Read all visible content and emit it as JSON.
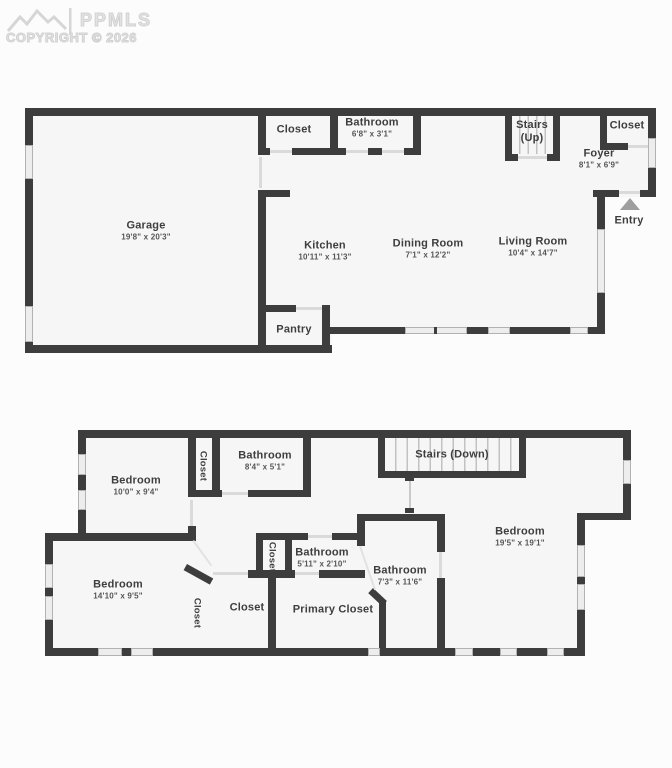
{
  "watermark": {
    "brand": "PPMLS",
    "copyright": "COPYRIGHT © 2026"
  },
  "floors": [
    {
      "name": "main-level",
      "rooms": [
        {
          "id": "garage",
          "label": "Garage",
          "dims": "19'8\" x 20'3\""
        },
        {
          "id": "closet-top",
          "label": "Closet",
          "dims": ""
        },
        {
          "id": "bathroom",
          "label": "Bathroom",
          "dims": "6'8\" x 3'1\""
        },
        {
          "id": "stairs-up",
          "label": "Stairs (Up)",
          "dims": ""
        },
        {
          "id": "closet-right",
          "label": "Closet",
          "dims": ""
        },
        {
          "id": "foyer",
          "label": "Foyer",
          "dims": "8'1\" x 6'9\""
        },
        {
          "id": "entry",
          "label": "Entry",
          "dims": ""
        },
        {
          "id": "kitchen",
          "label": "Kitchen",
          "dims": "10'11\" x 11'3\""
        },
        {
          "id": "dining-room",
          "label": "Dining Room",
          "dims": "7'1\" x 12'2\""
        },
        {
          "id": "living-room",
          "label": "Living Room",
          "dims": "10'4\" x 14'7\""
        },
        {
          "id": "pantry",
          "label": "Pantry",
          "dims": ""
        }
      ]
    },
    {
      "name": "upper-level",
      "rooms": [
        {
          "id": "bedroom-top-left",
          "label": "Bedroom",
          "dims": "10'0\" x 9'4\""
        },
        {
          "id": "closet-upper",
          "label": "Closet",
          "dims": ""
        },
        {
          "id": "bathroom-84",
          "label": "Bathroom",
          "dims": "8'4\" x 5'1\""
        },
        {
          "id": "stairs-down",
          "label": "Stairs (Down)",
          "dims": ""
        },
        {
          "id": "bedroom-right",
          "label": "Bedroom",
          "dims": "19'5\" x 19'1\""
        },
        {
          "id": "closet-mid",
          "label": "Closet",
          "dims": ""
        },
        {
          "id": "bathroom-511",
          "label": "Bathroom",
          "dims": "5'11\" x 2'10\""
        },
        {
          "id": "bathroom-73",
          "label": "Bathroom",
          "dims": "7'3\" x 11'6\""
        },
        {
          "id": "bedroom-bottom-left",
          "label": "Bedroom",
          "dims": "14'10\" x 9'5\""
        },
        {
          "id": "closet-lower",
          "label": "Closet",
          "dims": ""
        },
        {
          "id": "closet-room",
          "label": "Closet",
          "dims": ""
        },
        {
          "id": "primary-closet",
          "label": "Primary Closet",
          "dims": ""
        }
      ]
    }
  ]
}
